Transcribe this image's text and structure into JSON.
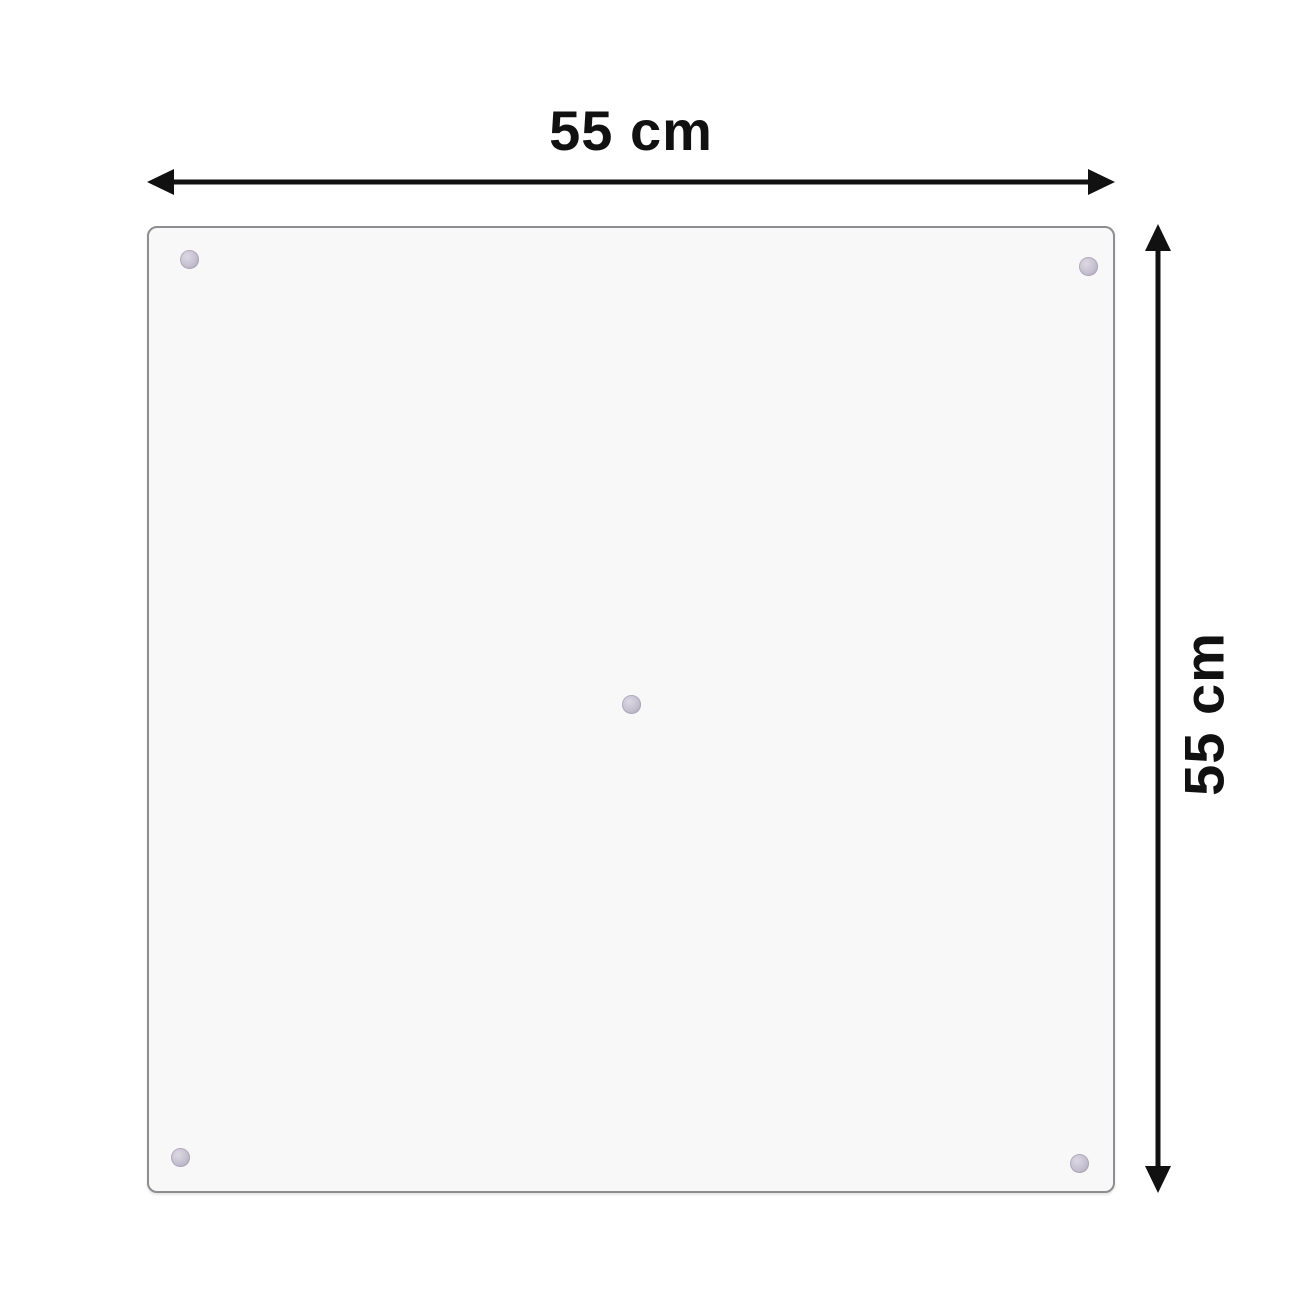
{
  "dimensions": {
    "width_label": "55 cm",
    "height_label": "55 cm"
  },
  "panel": {
    "shape": "square",
    "suction_cup_count": 5
  },
  "colors": {
    "page_bg": "#ffffff",
    "arrow_color": "#111111",
    "label_color": "#111111",
    "panel_fill": "#f8f8f9",
    "panel_border": "#8d8d92",
    "suction_cup_color": "#c7c2d1"
  }
}
